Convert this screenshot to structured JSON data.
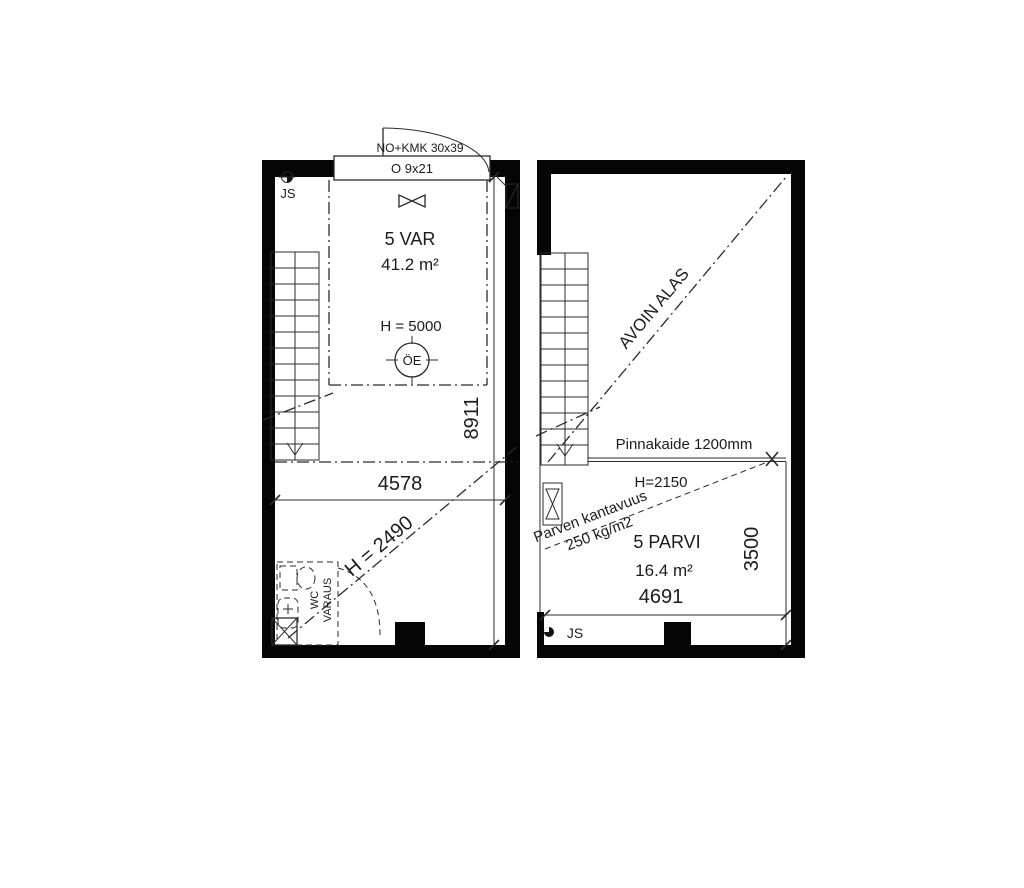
{
  "left_plan": {
    "door_label": "NO+KMK 30x39",
    "opening_label": "O 9x21",
    "corner_mark": "JS",
    "room_name": "5 VAR",
    "room_area": "41.2 m²",
    "ceiling_height": "H = 5000",
    "symbol_label": "ÖE",
    "width_dim": "4578",
    "height_dim": "8911",
    "lower_height": "H = 2490",
    "wc_line1": "WC",
    "wc_line2": "VARAUS"
  },
  "right_plan": {
    "open_to_below": "AVOIN ALAS",
    "railing_label": "Pinnakaide 1200mm",
    "clear_height": "H=2150",
    "load_line1": "Parven kantavuus",
    "load_line2": "250 kg/m2",
    "room_name": "5 PARVI",
    "room_area": "16.4 m²",
    "width_dim": "4691",
    "height_dim": "3500",
    "corner_mark": "JS"
  },
  "colors": {
    "wall": "#050505",
    "line": "#2b2b2b",
    "background": "#ffffff"
  }
}
